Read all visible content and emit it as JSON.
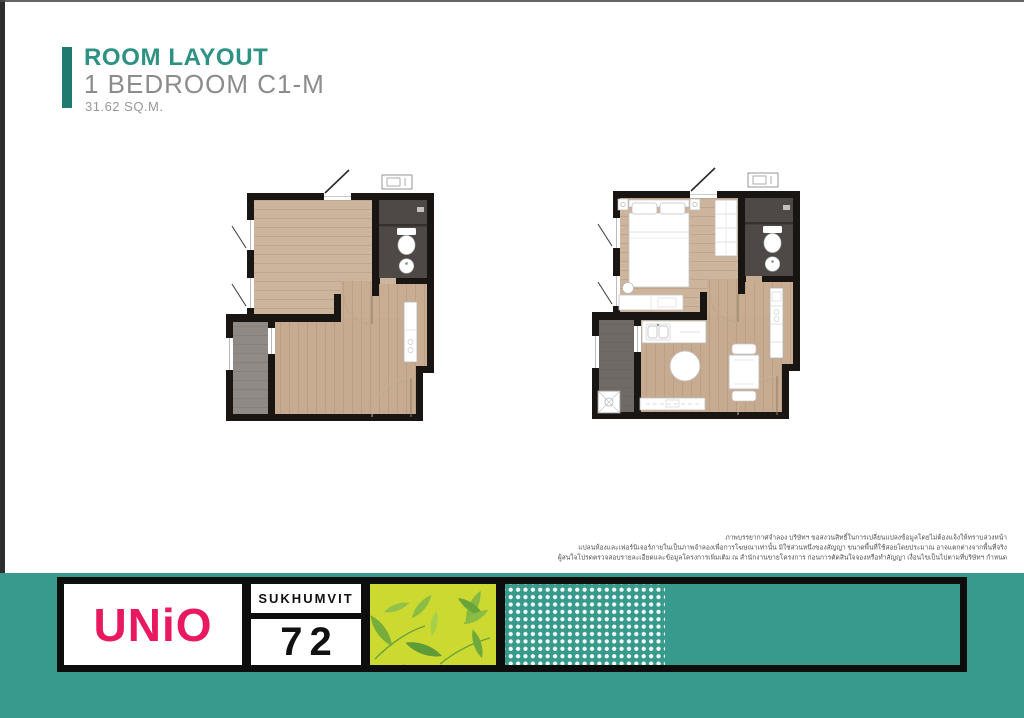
{
  "header": {
    "title": "ROOM LAYOUT",
    "subtitle": "1 BEDROOM C1-M",
    "area": "31.62 SQ.M."
  },
  "disclaimer": {
    "lines": [
      "ภาพบรรยากาศจำลอง บริษัทฯ ขอสงวนสิทธิ์ในการเปลี่ยนแปลงข้อมูลโดยไม่ต้องแจ้งให้ทราบล่วงหน้า",
      "แปลนห้องและเฟอร์นิเจอร์ภายในเป็นภาพจำลองเพื่อการโฆษณาเท่านั้น มิใช่ส่วนหนึ่งของสัญญา ขนาดพื้นที่ใช้สอยโดยประมาณ อาจแตกต่างจากพื้นที่จริง",
      "ผู้สนใจโปรดตรวจสอบรายละเอียดและข้อมูลโครงการเพิ่มเติม ณ สำนักงานขายโครงการ ก่อนการตัดสินใจจองหรือทำสัญญา เงื่อนไขเป็นไปตามที่บริษัทฯ กำหนด"
    ]
  },
  "footer": {
    "brand": "UNiO",
    "location": "SUKHUMVIT",
    "number": "72"
  },
  "colors": {
    "accent_teal": "#1e7a6e",
    "title_teal": "#2d9183",
    "footer_teal": "#389a8c",
    "brand_pink": "#e8195f",
    "leaf_green": "#cbd930",
    "wall_black": "#181512",
    "wood_floor": "#c8ad92",
    "bathroom_gray": "#4e4946",
    "balcony_gray": "#8f8a85"
  }
}
